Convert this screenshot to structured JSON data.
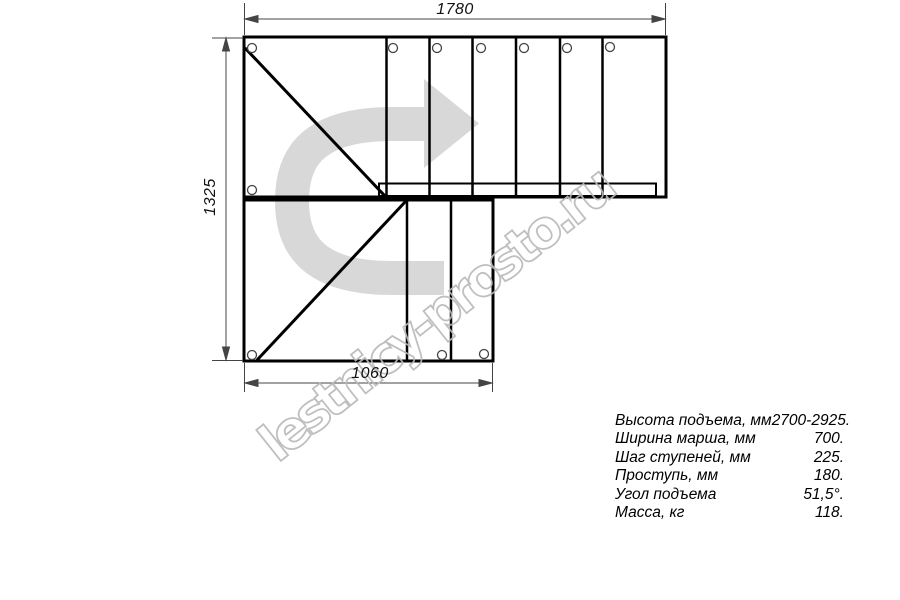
{
  "drawing": {
    "title": "stair-plan-top-view",
    "dim_top": "1780",
    "dim_left": "1325",
    "dim_bottom": "1060"
  },
  "watermark": {
    "text": "lestnicy-prosto.ru"
  },
  "specs": {
    "rows": [
      {
        "label": "Высота подъема, мм",
        "value": "2700-2925."
      },
      {
        "label": "Ширина марша, мм",
        "value": "700."
      },
      {
        "label": "Шаг ступеней, мм",
        "value": "225."
      },
      {
        "label": "Проступь, мм",
        "value": "180."
      },
      {
        "label": "Угол подъема",
        "value": "51,5°."
      },
      {
        "label": "Масса, кг",
        "value": "118."
      }
    ]
  },
  "icons": [
    {
      "name": "direction-arrow-icon",
      "meaning": "walk direction up the stairs, U-turn to the right"
    }
  ],
  "colors": {
    "background": "#ffffff",
    "line": "#000000",
    "thin_line": "#555555",
    "arrow_gray": "#d8d8d8",
    "watermark_gray": "#b9b9b9"
  }
}
